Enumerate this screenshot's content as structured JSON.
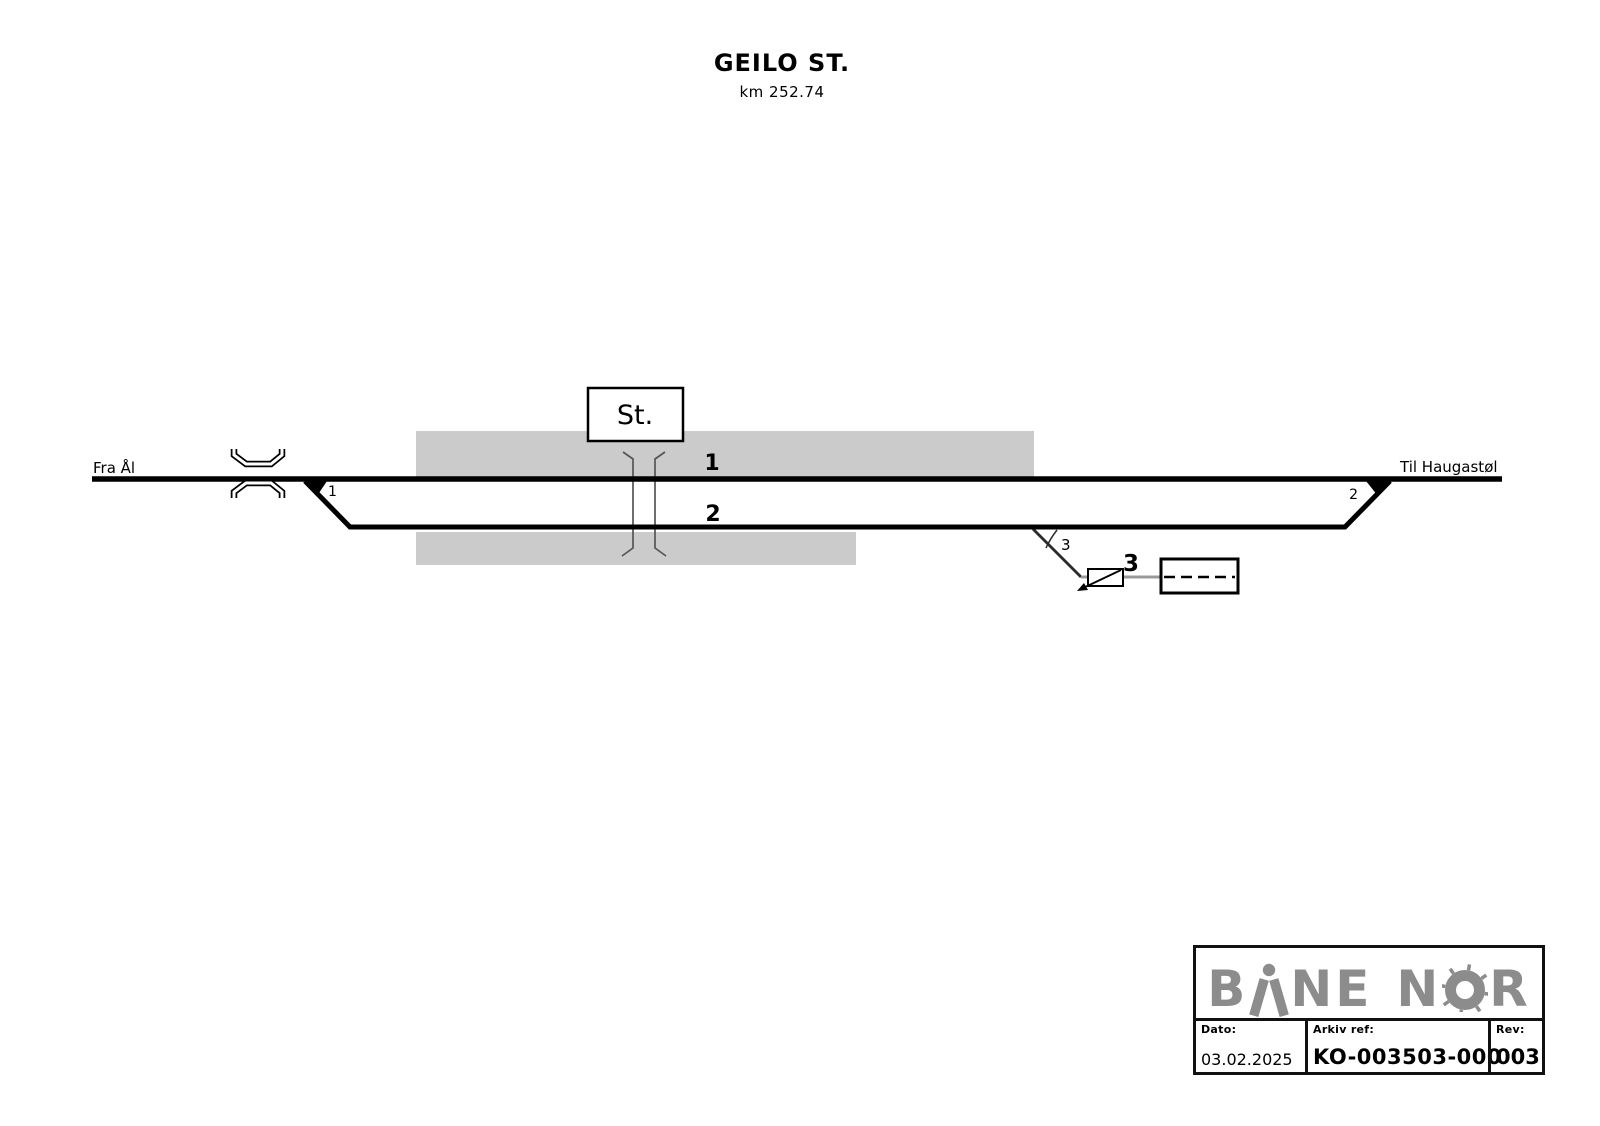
{
  "title": {
    "station": "GEILO ST.",
    "km": "km 252.74"
  },
  "diagram": {
    "from_label": "Fra Ål",
    "to_label": "Til Haugastøl",
    "station_box_label": "St.",
    "track_labels": {
      "track1": "1",
      "track2": "2",
      "track3": "3"
    },
    "switch_labels": {
      "switch1": "1",
      "switch2": "2",
      "switch3": "3"
    },
    "colors": {
      "track": "#000000",
      "platform": "#cbcbcb",
      "siding_line": "#999999",
      "crossing_line": "#555555"
    }
  },
  "title_block": {
    "logo": {
      "p1": "B",
      "p2": "NE",
      "p3": "N",
      "p4": "R",
      "color": "#8c8c8c"
    },
    "fields": [
      {
        "label": "Dato:",
        "value": "03.02.2025"
      },
      {
        "label": "Arkiv ref:",
        "value": "KO-003503-000"
      },
      {
        "label": "Rev:",
        "value": "003"
      }
    ]
  }
}
